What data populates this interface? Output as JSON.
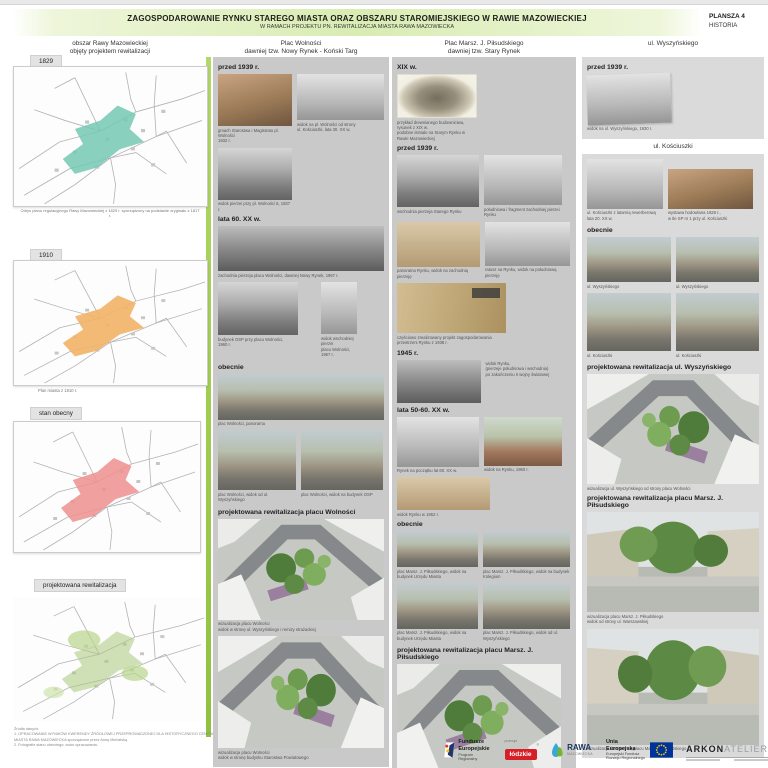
{
  "header": {
    "title": "ZAGOSPODAROWANIE RYNKU STAREGO MIASTA ORAZ OBSZARU STAROMIEJSKIEGO W RAWIE MAZOWIECKIEJ",
    "subtitle": "W RAMACH PROJEKTU PN. REWITALIZACJA MIASTA RAWA MAZOWIECKA",
    "board_no": "PLANSZA 4",
    "board_topic": "HISTORIA"
  },
  "left": {
    "title": [
      "obszar Rawy Mazowieckiej",
      "objęty projektem rewitalizacji"
    ],
    "maps": [
      {
        "label": "1829",
        "caption": "Odrys planu regulacyjnego Rawy Mazowieckiej z 1829 r. sporządzony na podstawie oryginału z 1817 r.",
        "highlight": "#76c8b4"
      },
      {
        "label": "1910",
        "caption": "Plan miasta z 1910 r.",
        "highlight": "#f2b267"
      },
      {
        "label": "stan obecny",
        "caption": "",
        "highlight": "#ef8f8f"
      },
      {
        "label": "projektowana rewitalizacja",
        "caption": "",
        "highlight": "#a9c97c"
      }
    ],
    "footnote": [
      "Źródła danych:",
      "1. OPRACOWANIE WYNIKÓW KWERENDY ŹRÓDŁOWEJ PRZEPROWADZONEJ DLA HISTORYCZNEGO CENTRUM",
      "MIASTA RAWA MAZOWIECKA sporządzone przez Annę Michalską",
      "2. Fotografie stanu obecnego: autor opracowania."
    ]
  },
  "col2": {
    "title": [
      "Plac Wolności",
      "dawniej tzw. Nowy Rynek - Koński Targ"
    ],
    "sections": [
      {
        "label": "przed 1939 r.",
        "photos": [
          {
            "caption": [
              "gmach Starostwa i Magistratu pl. Wolności",
              "1932 r."
            ]
          },
          {
            "caption": [
              "widok na pl. Wolności od strony",
              "ul. Kościuszki, lata 30. XX w."
            ]
          },
          {
            "caption": [
              "widok pierzei przy pl. Wolności 6, 1937 r."
            ]
          }
        ]
      },
      {
        "label": "lata 60. XX w.",
        "photos": [
          {
            "caption": [
              "zachodnia pierzeja placu Wolności, dawniej Nowy Rynek, 1967 r."
            ]
          },
          {
            "caption": [
              "budynek OSP przy placu Wolności,",
              "1960 r."
            ]
          },
          {
            "caption": [
              "widok wschodniej pierzei",
              "placu Wolności, 1967 r."
            ]
          }
        ]
      },
      {
        "label": "obecnie",
        "photos": [
          {
            "caption": [
              "plac Wolności, panorama"
            ]
          },
          {
            "caption": [
              "plac Wolności, widok od ul. Wyszyńskiego"
            ]
          },
          {
            "caption": [
              "plac Wolności, widok na budynek OSP"
            ]
          }
        ]
      },
      {
        "label": "projektowana rewitalizacja placu Wolności",
        "photos": [
          {
            "caption": [
              "wizualizacja placu Wolności",
              "widok w stronę ul. Wyszyńskiego i remizy strażackiej"
            ]
          },
          {
            "caption": [
              "wizualizacja placu Wolności",
              "widok w stronę budynku Starostwa Powiatowego"
            ]
          }
        ]
      }
    ]
  },
  "col3": {
    "title": [
      "Plac Marsz. J. Piłsudskiego",
      "dawniej tzw. Stary Rynek"
    ],
    "sections": [
      {
        "label": "XIX w.",
        "photos": [
          {
            "caption": [
              "przykład drewnianego budownictwa, rysunek z XIX w.",
              "podobne istniało na Starym Rynku w Rawie Mazowieckiej"
            ]
          }
        ]
      },
      {
        "label": "przed 1939 r.",
        "photos": [
          {
            "caption": [
              "wschodnia pierzeja Starego Rynku"
            ]
          },
          {
            "caption": [
              "południowa i fragment zachodniej pierzei Rynku"
            ]
          },
          {
            "caption": [
              "panorama Rynku, widok na zachodnią pierzeję"
            ]
          },
          {
            "caption": [
              "ratusz na Rynku, widok na południową pierzeję"
            ]
          },
          {
            "caption": [
              "częściowo zrealizowany projekt zagospodarowania przestrzeni Rynku z 1938 r."
            ]
          }
        ]
      },
      {
        "label": "1945 r.",
        "photos": [
          {
            "caption": [
              "widok Rynku,",
              "(pierzeje południowa i wschodnia)",
              "po zakończeniu II wojny światowej"
            ]
          }
        ]
      },
      {
        "label": "lata 50-60. XX w.",
        "photos": [
          {
            "caption": [
              "Rynek na początku lat 60. XX w."
            ]
          },
          {
            "caption": [
              "widok na Rynku, 1960 r."
            ]
          },
          {
            "caption": [
              "widok Rynku w 1952 r."
            ]
          }
        ]
      },
      {
        "label": "obecnie",
        "photos": [
          {
            "caption": [
              "plac Marsz. J. Piłsudskiego, widok na budynek Urzędu Miasta"
            ]
          },
          {
            "caption": [
              "plac Marsz. J. Piłsudskiego, widok na budynek Kolegium"
            ]
          },
          {
            "caption": [
              "plac Marsz. J. Piłsudskiego, widok na budynek Urzędu Miasta"
            ]
          },
          {
            "caption": [
              "plac Marsz. J. Piłsudskiego, widok od ul. Wyszyńskiego"
            ]
          }
        ]
      },
      {
        "label": "projektowana rewitalizacja placu Marsz. J. Piłsudskiego",
        "photos": [
          {
            "caption": [
              "wizualizacja placu Marsz. J. Piłsudskiego",
              "widok na budynek Urzędu Miasta"
            ]
          }
        ]
      }
    ]
  },
  "col4": {
    "title": "ul. Wyszyńskiego",
    "subtitle": "ul. Kościuszki",
    "sections": [
      {
        "label": "przed 1939 r.",
        "photos": [
          {
            "caption": [
              "widok na ul. Wyszyńskiego, 1930 r."
            ]
          }
        ]
      },
      {
        "label": "",
        "photos": [
          {
            "caption": [
              "ul. Kościuszki z latarnią rewerberową",
              "lata 20. XX w."
            ]
          },
          {
            "caption": [
              "wystawa hodowlana 1928 r.,",
              "w tle SP nr 1 przy ul. Kościuszki"
            ]
          }
        ]
      },
      {
        "label": "obecnie",
        "photos": [
          {
            "caption": [
              "ul. Wyszyńskiego"
            ]
          },
          {
            "caption": [
              "ul. Wyszyńskiego"
            ]
          },
          {
            "caption": [
              "ul. Kościuszki"
            ]
          },
          {
            "caption": [
              "ul. Kościuszki"
            ]
          }
        ]
      },
      {
        "label": "projektowana rewitalizacja ul. Wyszyńskiego",
        "photos": [
          {
            "caption": [
              "wizualizacja ul. Wyszyńskiego od strony placu Wolności"
            ]
          }
        ]
      },
      {
        "label": "projektowana rewitalizacja  placu Marsz. J. Piłsudskiego",
        "photos": [
          {
            "caption": [
              "wizualizacja placu Marsz. J. Piłsudskiego",
              "widok od strony ul. Warszawskiej"
            ]
          },
          {
            "caption": [
              "wizualizacja fontanny na placu Marsz. J. Piłsudskiego"
            ]
          }
        ]
      }
    ]
  },
  "footer": {
    "logos": [
      {
        "lines": [
          "Fundusze",
          "Europejskie",
          "Program Regionalny"
        ]
      },
      {
        "promuje": "promuje",
        "label": "łódzkie"
      },
      {
        "label": "RAWA",
        "sub": "MAZOWIECKA"
      },
      {
        "lines": [
          "Unia Europejska",
          "Europejski Fundusz",
          "Rozwoju Regionalnego"
        ]
      },
      {
        "label1": "ARKON",
        "label2": "ATELIER"
      }
    ]
  },
  "colors": {
    "accent_green": "#a3cc4e",
    "panel_gray": "#c9c9c9",
    "panel_gray_light": "#dadada"
  }
}
